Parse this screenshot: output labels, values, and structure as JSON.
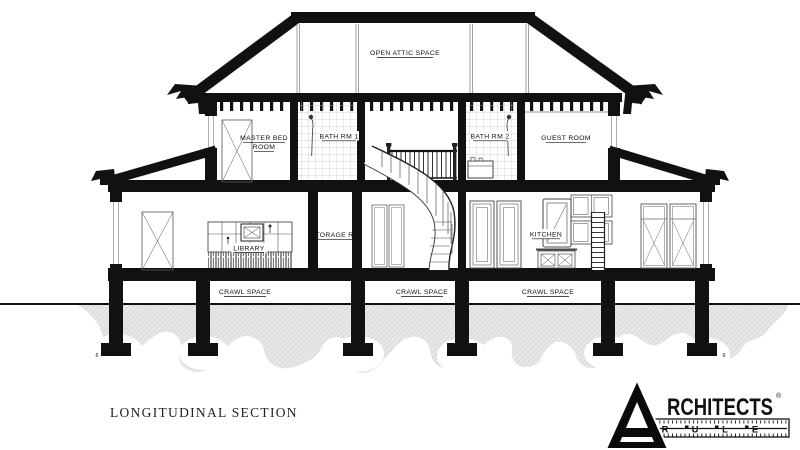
{
  "drawing": {
    "title": "LONGITUDINAL SECTION",
    "labels": {
      "attic": "OPEN ATTIC SPACE",
      "master_bed_1": "MASTER BED",
      "master_bed_2": "ROOM",
      "bath_1": "BATH RM 1",
      "bath_2": "BATH RM 2",
      "guest": "GUEST ROOM",
      "library": "LIBRARY",
      "storage": "STORAGE RM",
      "kitchen": "KITCHEN",
      "crawl_left": "CRAWL SPACE",
      "crawl_center": "CRAWL SPACE",
      "crawl_right": "CRAWL SPACE",
      "footing_left": "6",
      "footing_right": "6"
    },
    "colors": {
      "ink": "#111111",
      "soil_fill": "#e7e7e7",
      "soil_hatch": "#cfcfcf",
      "tile_line": "#c4c4c4"
    }
  },
  "logo": {
    "initial_letter": "A",
    "wordmark": "RCHITECTS",
    "registered": "®",
    "ruler_letters": [
      "R",
      "U",
      "L",
      "E"
    ]
  }
}
